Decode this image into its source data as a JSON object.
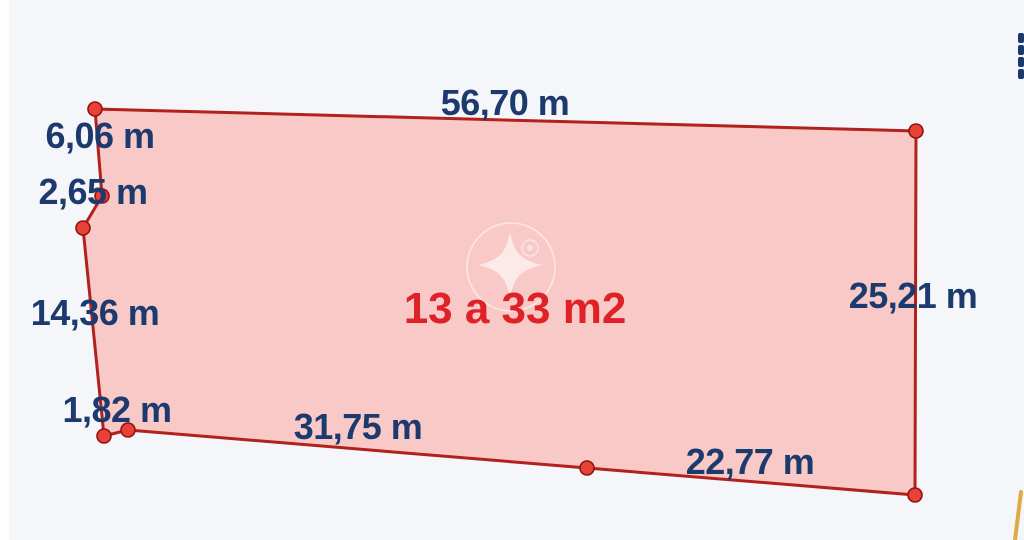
{
  "diagram": {
    "type": "land-plot-dimension-sketch",
    "labels": {
      "top": "56,70 m",
      "left_upper": "6,06 m",
      "left_mid": "2,65 m",
      "left_lower": "14,36 m",
      "bottom_left": "1,82 m",
      "bottom_mid": "31,75 m",
      "bottom_right": "22,77 m",
      "right": "25,21 m",
      "area": "13 a 33 m2"
    },
    "geometry": {
      "vertices": [
        [
          95,
          109
        ],
        [
          916,
          131
        ],
        [
          915,
          495
        ],
        [
          587,
          468
        ],
        [
          128,
          430
        ],
        [
          104,
          436
        ],
        [
          83,
          228
        ],
        [
          102,
          196
        ]
      ],
      "adjacent_line": [
        [
          1021,
          492
        ],
        [
          1018,
          516
        ],
        [
          1015,
          540
        ]
      ],
      "clipped_text_marks": [
        [
          1018,
          33,
          6,
          10
        ],
        [
          1018,
          45,
          6,
          10
        ],
        [
          1018,
          57,
          6,
          10
        ],
        [
          1018,
          69,
          6,
          10
        ]
      ],
      "watermark": {
        "circle_center": [
          511,
          267
        ],
        "circle_radius": 44,
        "star_center": [
          510,
          265
        ],
        "star_radius": 32,
        "badge_center": [
          530,
          248
        ],
        "badge_radius": 8
      }
    },
    "colors": {
      "background": "#f4f6f9",
      "fill": "#f8c9c6",
      "stroke": "#b2211c",
      "vertex": "#e84138",
      "vertex_ring": "#8f1410",
      "label_text": "#1d3a6e",
      "area_text": "#de2228",
      "adjacent_line": "#dda43c"
    }
  }
}
